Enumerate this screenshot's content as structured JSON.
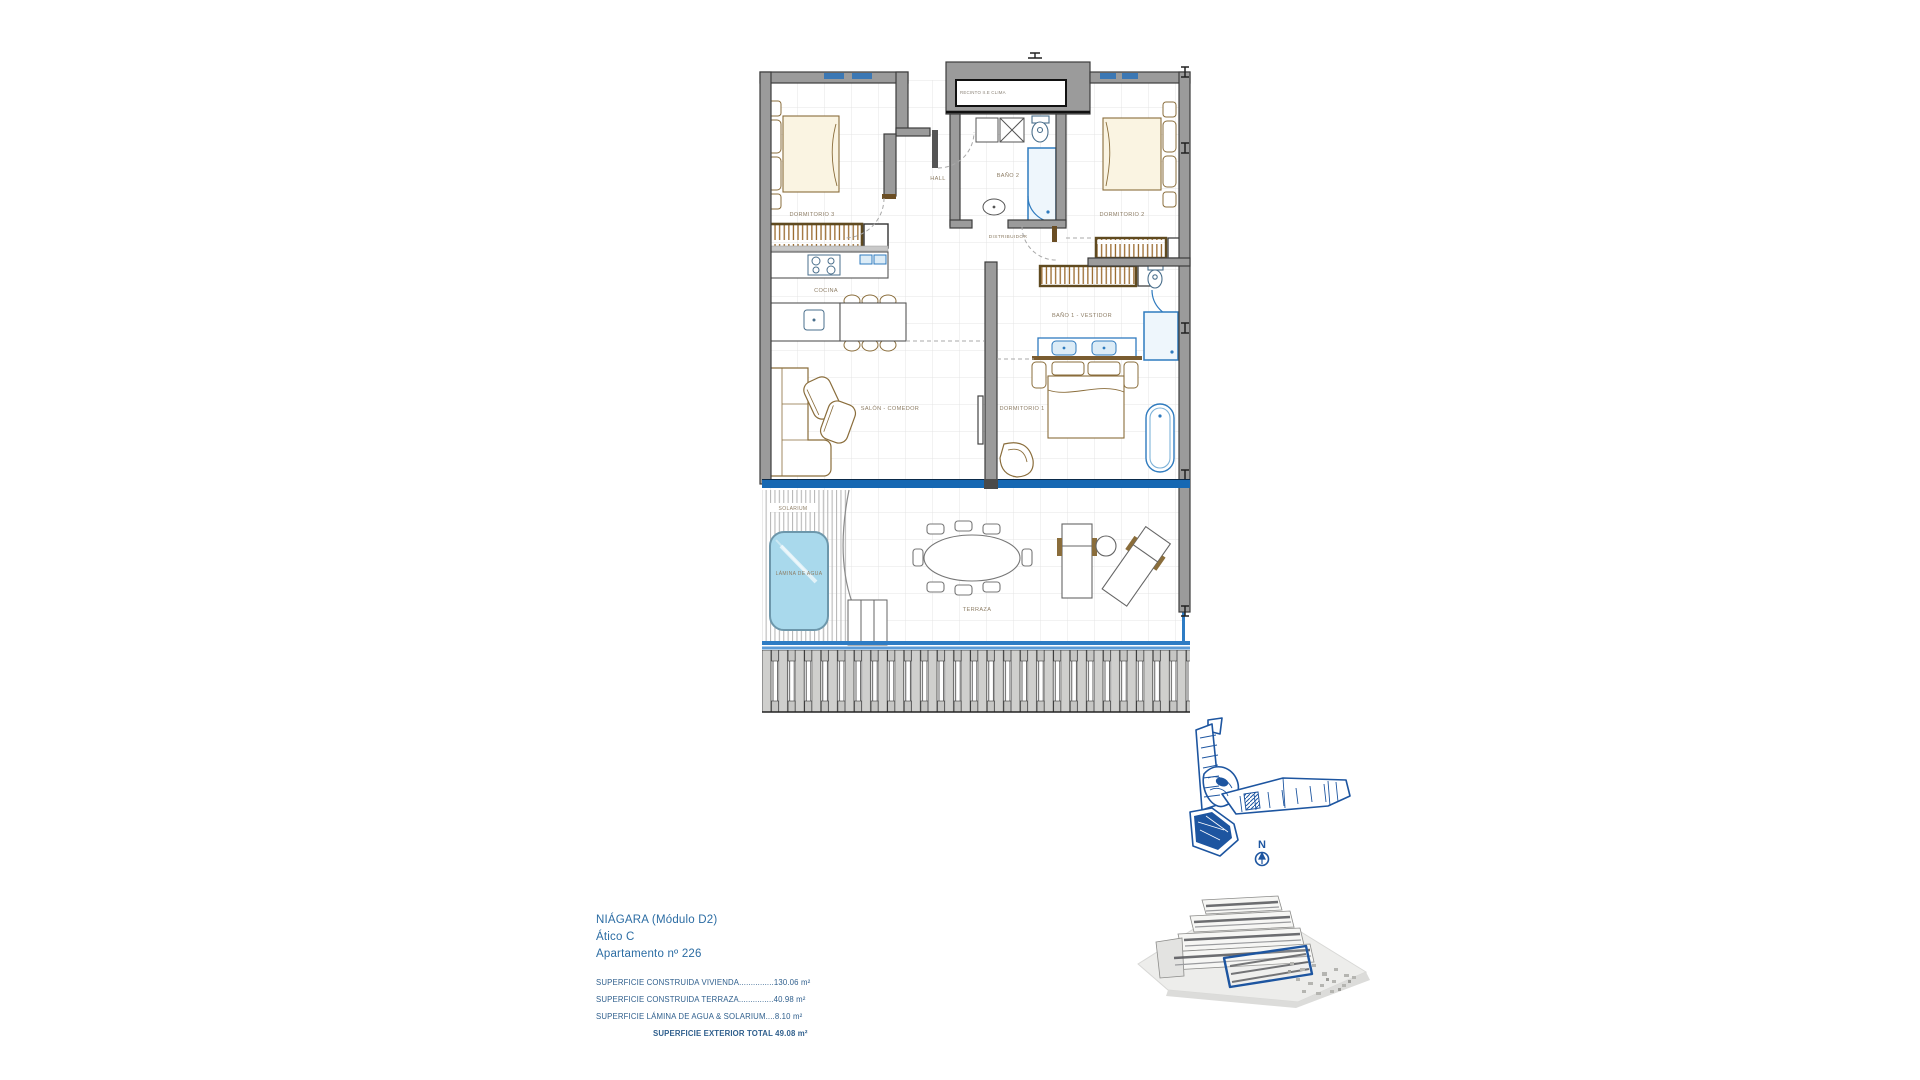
{
  "plan": {
    "labels": {
      "recinto": "RECINTO II.E CLIMA",
      "dormitorio3": "DORMITORIO 3",
      "hall": "HALL",
      "bano2": "BAÑO 2",
      "dormitorio2": "DORMITORIO 2",
      "cocina": "COCINA",
      "distribuidor": "DISTRIBUIDOR",
      "bano1": "BAÑO 1 - VESTIDOR",
      "salon": "SALÓN - COMEDOR",
      "dormitorio1": "DORMITORIO 1",
      "solarium": "SOLARIUM",
      "lamina": "LÁMINA DE AGUA",
      "terraza": "TERRAZA"
    },
    "colors": {
      "wall": "#9b9b9b",
      "wall_stroke": "#3c3c3c",
      "furniture_tan": "#8a6d3b",
      "fixture_blue": "#2f7bbf",
      "glass_blue": "#1668b3",
      "pool_fill": "#a9d9ec",
      "label_brown": "#8d7d65",
      "site_blue": "#1d55a0"
    }
  },
  "site": {
    "compass": "N"
  },
  "info": {
    "title_line1": "NIÁGARA (Módulo D2)",
    "title_line2": "Ático C",
    "title_line3": "Apartamento nº 226",
    "areas": [
      "SUPERFICIE CONSTRUIDA VIVIENDA...............130.06 m²",
      "SUPERFICIE CONSTRUIDA TERRAZA...............40.98 m²",
      "SUPERFICIE LÁMINA DE AGUA & SOLARIUM....8.10 m²"
    ],
    "total": "SUPERFICIE EXTERIOR TOTAL 49.08 m²"
  }
}
